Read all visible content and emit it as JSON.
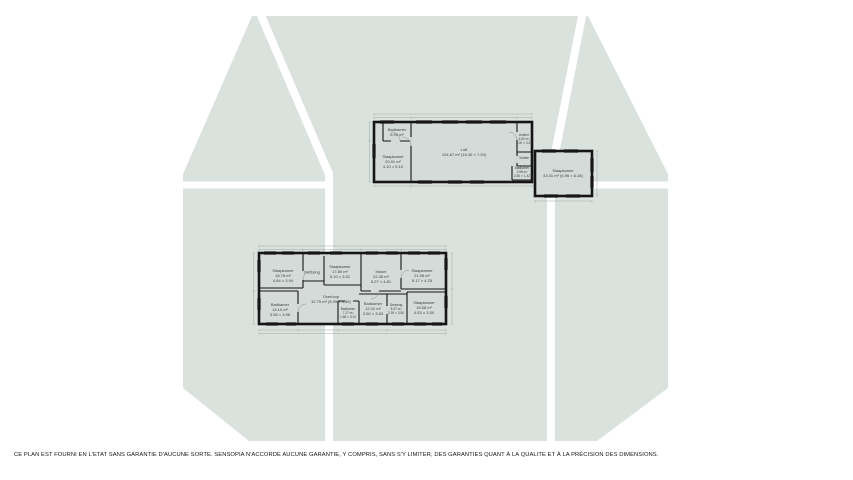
{
  "page": {
    "background_color": "#ffffff",
    "silhouette_color": "#dae2de",
    "room_fill_color": "#d4dbd8",
    "wall_color": "#161616",
    "dimension_line_color": "#9aa29e"
  },
  "disclaimer": "CE PLAN EST FOURNI EN L'ETAT SANS GARANTIE D'AUCUNE SORTE. SENSOPIA N'ACCORDE AUCUNE GARANTIE, Y COMPRIS, SANS S'Y LIMITER, DES GARANTIES QUANT À LA QUALITE ET À LA PRÉCISION DES DIMENSIONS.",
  "floors": {
    "upper": {
      "rooms": [
        {
          "name": "Badkamer",
          "area": "5.95 m²"
        },
        {
          "name": "Slaapkamer",
          "area": "20.91 m²",
          "dims": "4.10 × 5.10"
        },
        {
          "name": "Loft",
          "area": "104.67 m² (16.45 × 7.20)"
        },
        {
          "name": "Andere",
          "area": "6.50 m²",
          "dims": "2.00 × 3.25"
        },
        {
          "name": "Toilette"
        },
        {
          "name": "Badkamer",
          "area": "3.98 m²",
          "dims": "2.80 × 1.42"
        },
        {
          "name": "Slaapkamer",
          "area": "43.01 m² (6.96 × 6.18)"
        }
      ]
    },
    "lower": {
      "rooms": [
        {
          "name": "Slaapkamer",
          "area": "18.78 m²",
          "dims": "4.84 × 3.94"
        },
        {
          "name": "Dressing"
        },
        {
          "name": "Slaapkamer",
          "area": "17.80 m²",
          "dims": "5.10 × 3.51"
        },
        {
          "name": "Inkom",
          "area": "22.28 m²",
          "dims": "5.27 × 4.81"
        },
        {
          "name": "Slaapkamer",
          "area": "21.96 m²",
          "dims": "5.17 × 4.25"
        },
        {
          "name": "Overloop",
          "area": "32.75 m² (8.95 × 4.86)"
        },
        {
          "name": "Badkamer",
          "area": "14.10 m²",
          "dims": "3.56 × 3.96"
        },
        {
          "name": "Badkamer",
          "area": "7.17 m²",
          "dims": "1.68 × 3.10"
        },
        {
          "name": "Badkamer",
          "area": "12.41 m²",
          "dims": "3.50 × 3.63"
        },
        {
          "name": "Dressing",
          "area": "8.37 m²",
          "dims": "2.39 × 3.50"
        },
        {
          "name": "Slaapkamer",
          "area": "15.58 m²",
          "dims": "4.53 × 3.50"
        }
      ]
    }
  }
}
